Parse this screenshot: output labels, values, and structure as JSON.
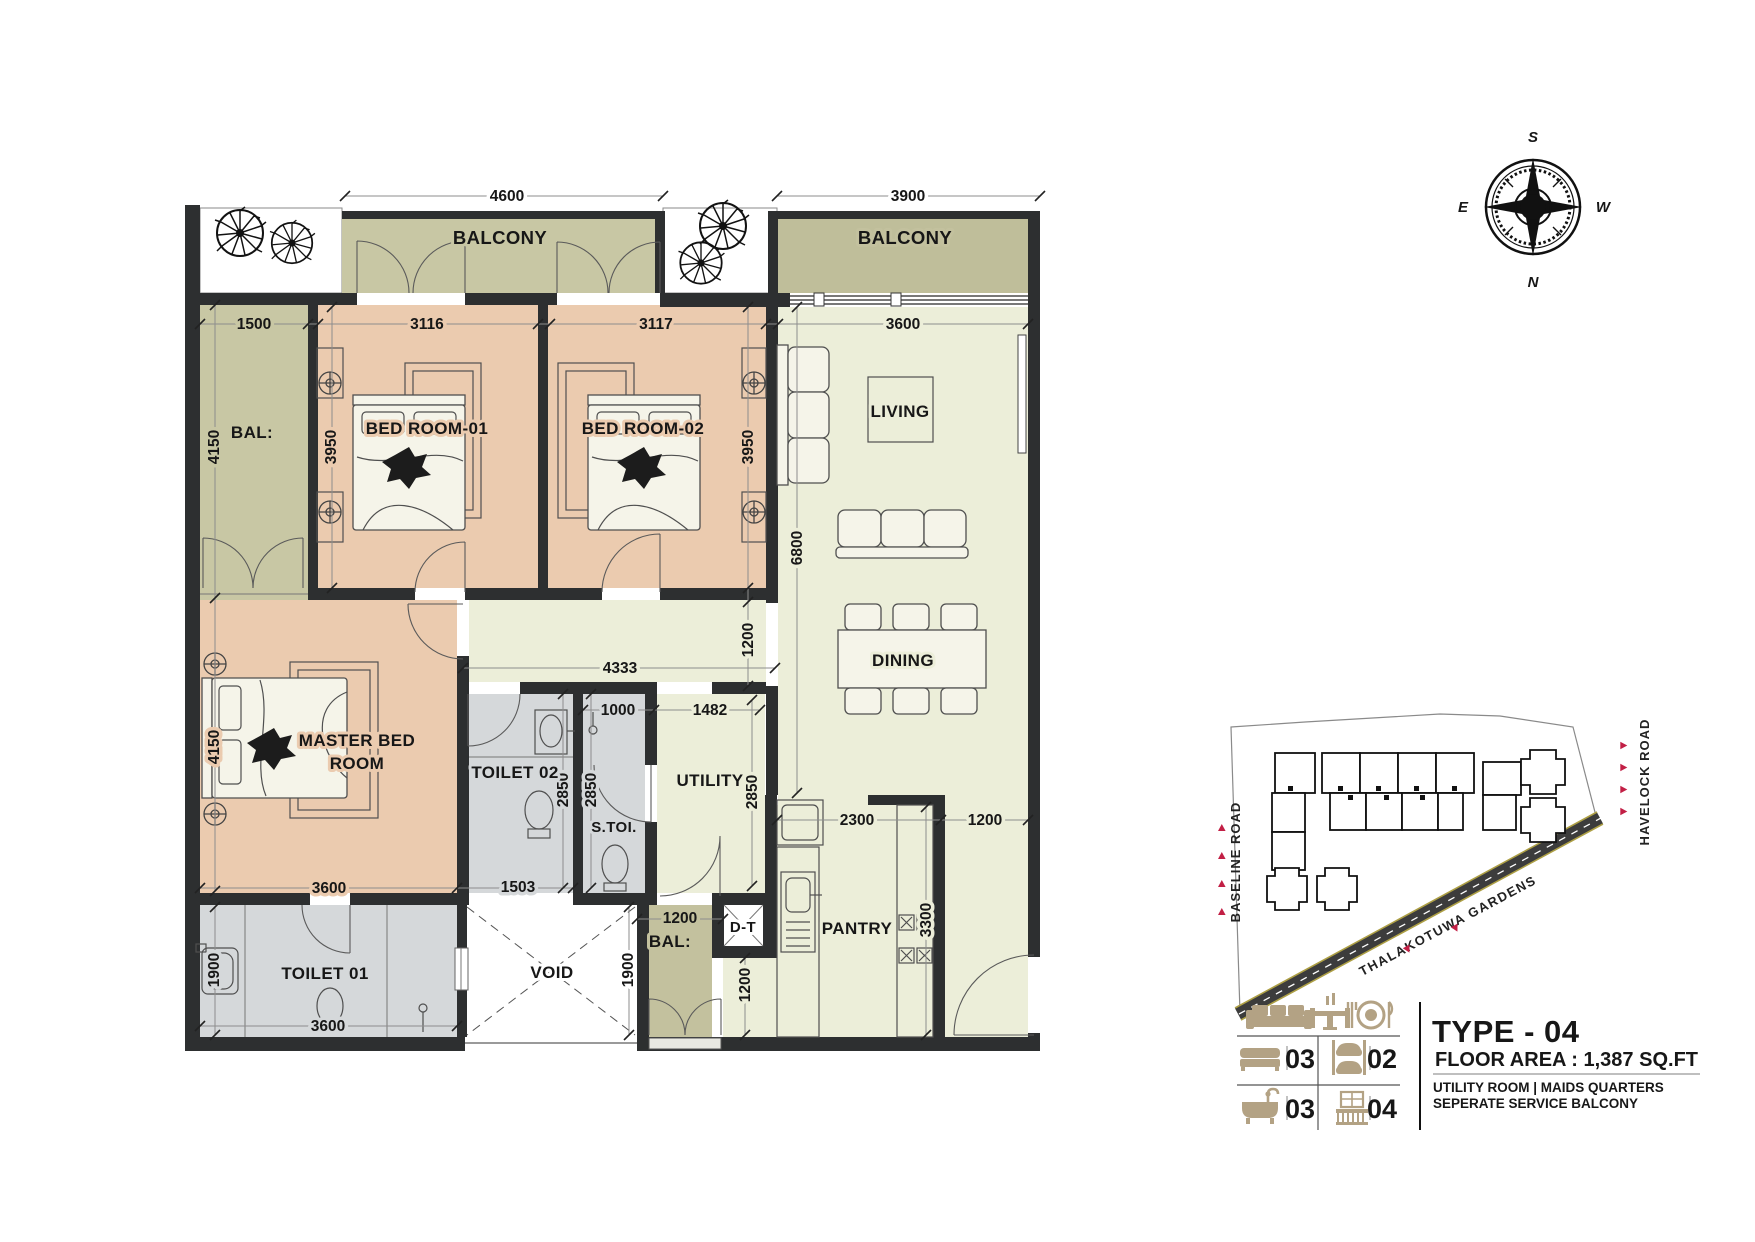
{
  "plan": {
    "rooms": {
      "balcony_1": "BALCONY",
      "balcony_2": "BALCONY",
      "bal_left": "BAL:",
      "bed1": "BED ROOM-01",
      "bed2": "BED ROOM-02",
      "living": "LIVING",
      "master_line1": "MASTER BED",
      "master_line2": "ROOM",
      "toilet2": "TOILET 02",
      "stoi": "S.TOI.",
      "utility": "UTILITY",
      "dining": "DINING",
      "toilet1": "TOILET 01",
      "void": "VOID",
      "bal_bottom": "BAL:",
      "dt": "D-T",
      "pantry": "PANTRY"
    },
    "dims": [
      "4600",
      "3900",
      "1500",
      "3116",
      "3117",
      "3600",
      "4150",
      "3950",
      "3950",
      "6800",
      "1200",
      "4333",
      "1000",
      "1482",
      "4150",
      "2850",
      "2850",
      "2850",
      "2300",
      "1200",
      "3600",
      "1503",
      "1900",
      "1900",
      "1200",
      "1200",
      "3300",
      "3600"
    ]
  },
  "compass": {
    "s": "S",
    "e": "E",
    "w": "W",
    "n": "N"
  },
  "site_map": {
    "baseline_road": "BASELINE ROAD",
    "havelock_road": "HAVELOCK ROAD",
    "thalakotuwa": "THALAKOTUWA GARDENS"
  },
  "legend": {
    "bedrooms": "03",
    "parking": "02",
    "bathrooms": "03",
    "balconies": "04",
    "type_title": "TYPE - 04",
    "floor_area": "FLOOR AREA : 1,387 SQ.FT",
    "note_line1": "UTILITY ROOM | MAIDS QUARTERS",
    "note_line2": "SEPERATE SERVICE BALCONY"
  },
  "colors": {
    "wall": "#2d2f30",
    "bedroom_fill": "#ebcbaf",
    "living_fill": "#eceed9",
    "balcony_light": "#c8c7a4",
    "balcony_dark": "#bfbe9a",
    "toilet_fill": "#d5d8da",
    "legend_tan": "#b3a284",
    "marker_red": "#c21f45",
    "site_highlight": "#e9e9d2"
  }
}
